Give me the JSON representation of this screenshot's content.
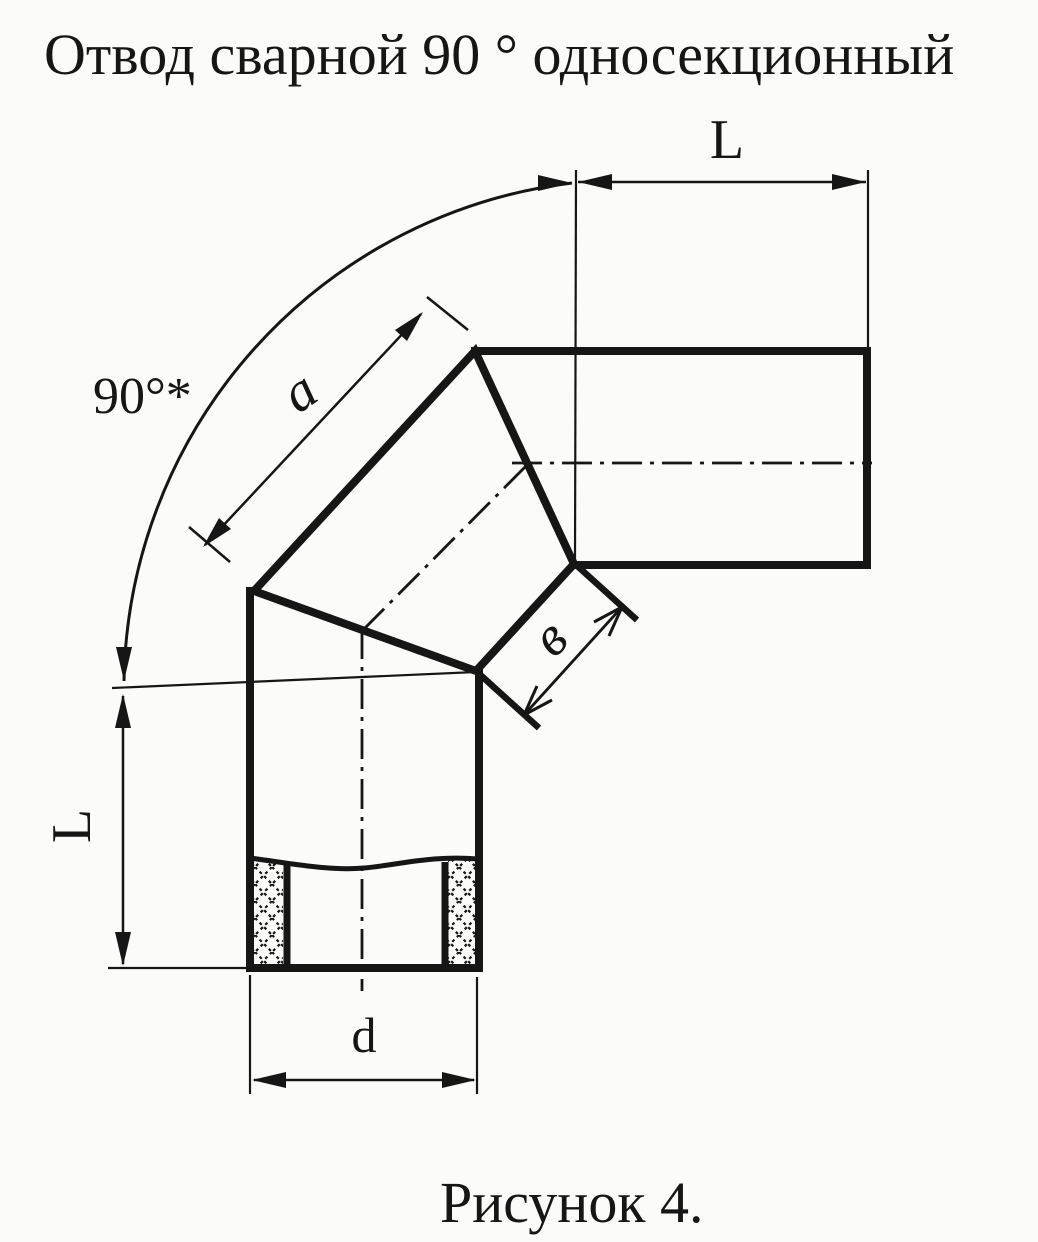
{
  "page": {
    "paper_color": "#fbfbf9",
    "ink_color": "#161616"
  },
  "title": "Отвод сварной 90 ° односекционный",
  "caption": "Рисунок 4.",
  "dimensions": {
    "angle_label": "90°*",
    "top_run_length": "L",
    "left_run_length": "L",
    "segment_edge_length": "a",
    "miter_seam_width": "в",
    "bore_diameter": "d"
  }
}
